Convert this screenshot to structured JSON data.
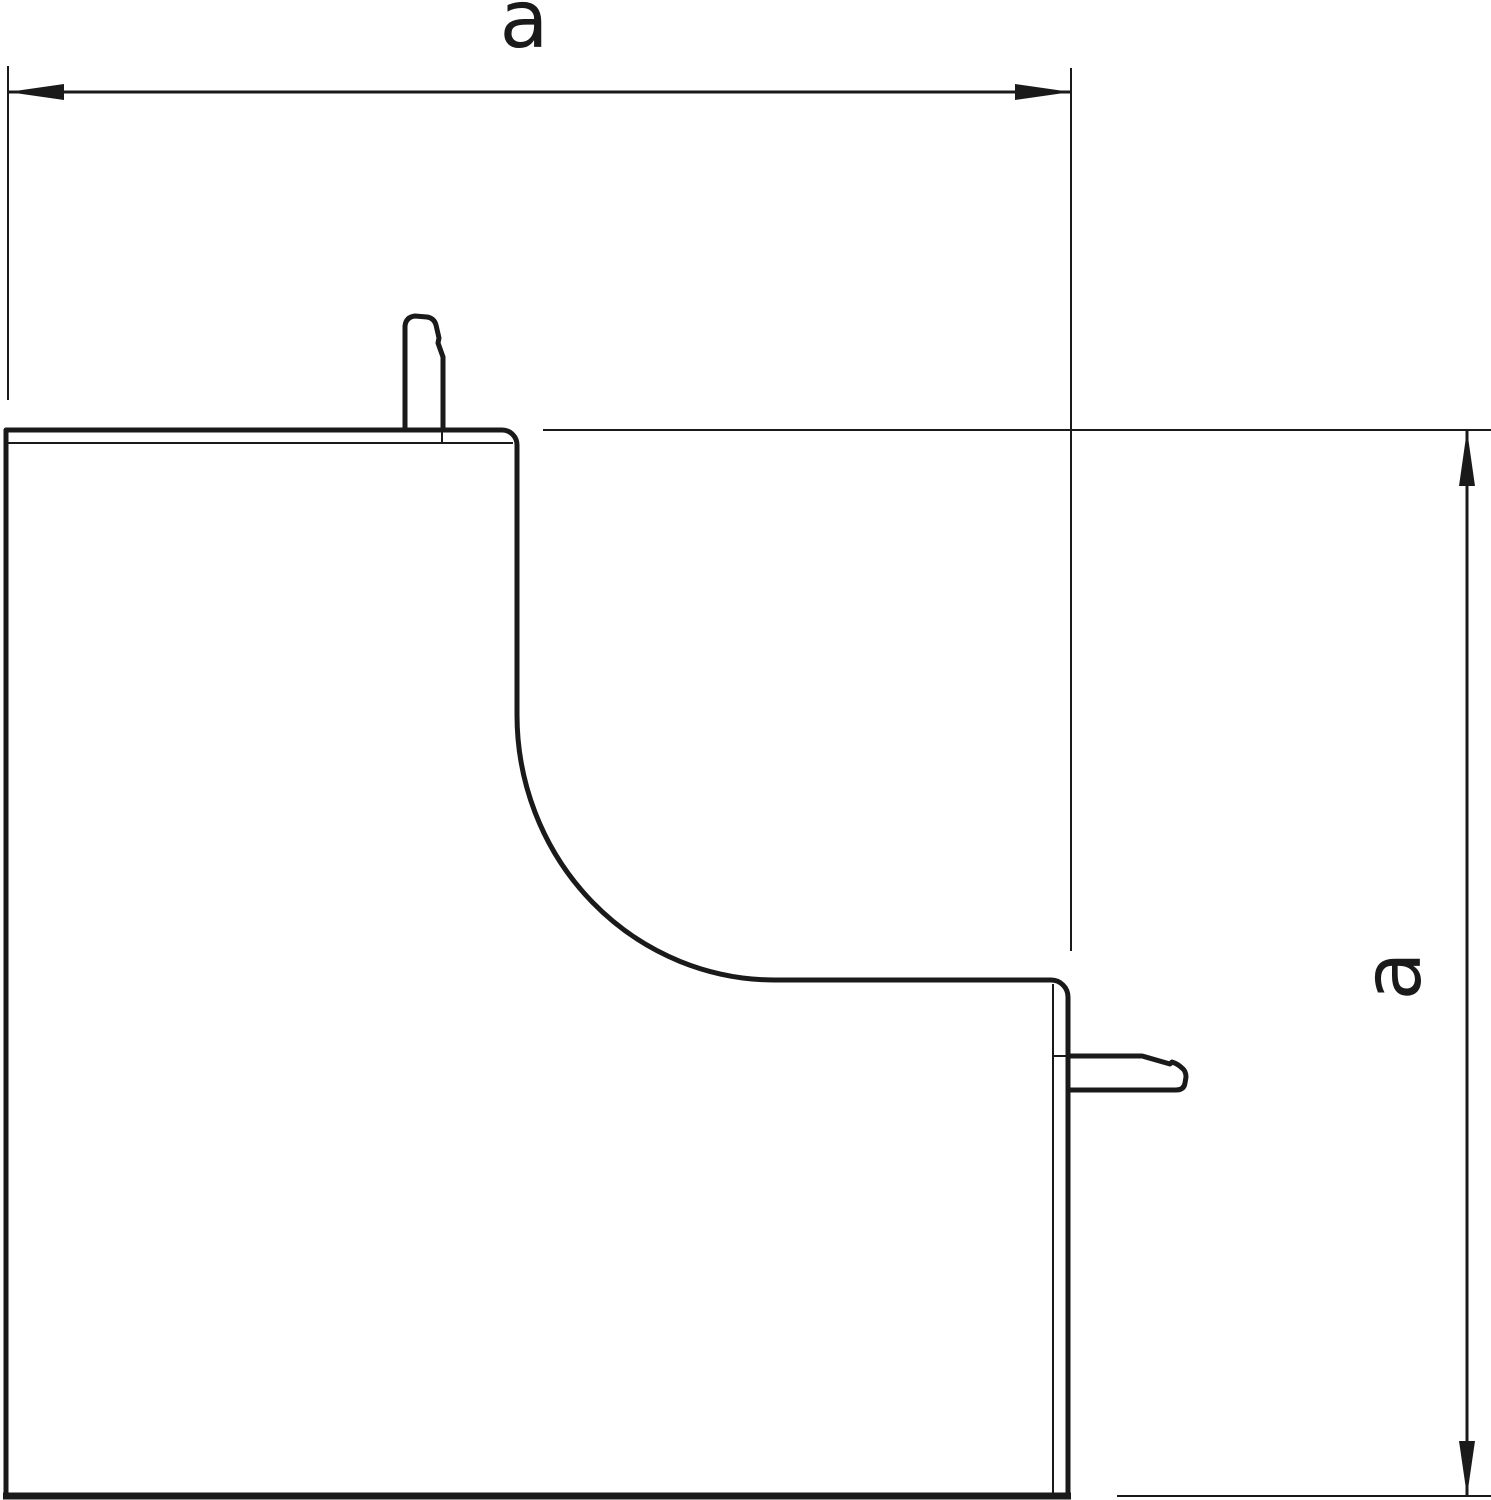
{
  "drawing": {
    "kind": "dimensioned outline drawing of an internal corner trunking cover",
    "labels": {
      "top_dimension": "a",
      "right_dimension": "a"
    },
    "colors": {
      "line": "#1a1a1a",
      "background": "#ffffff"
    }
  }
}
